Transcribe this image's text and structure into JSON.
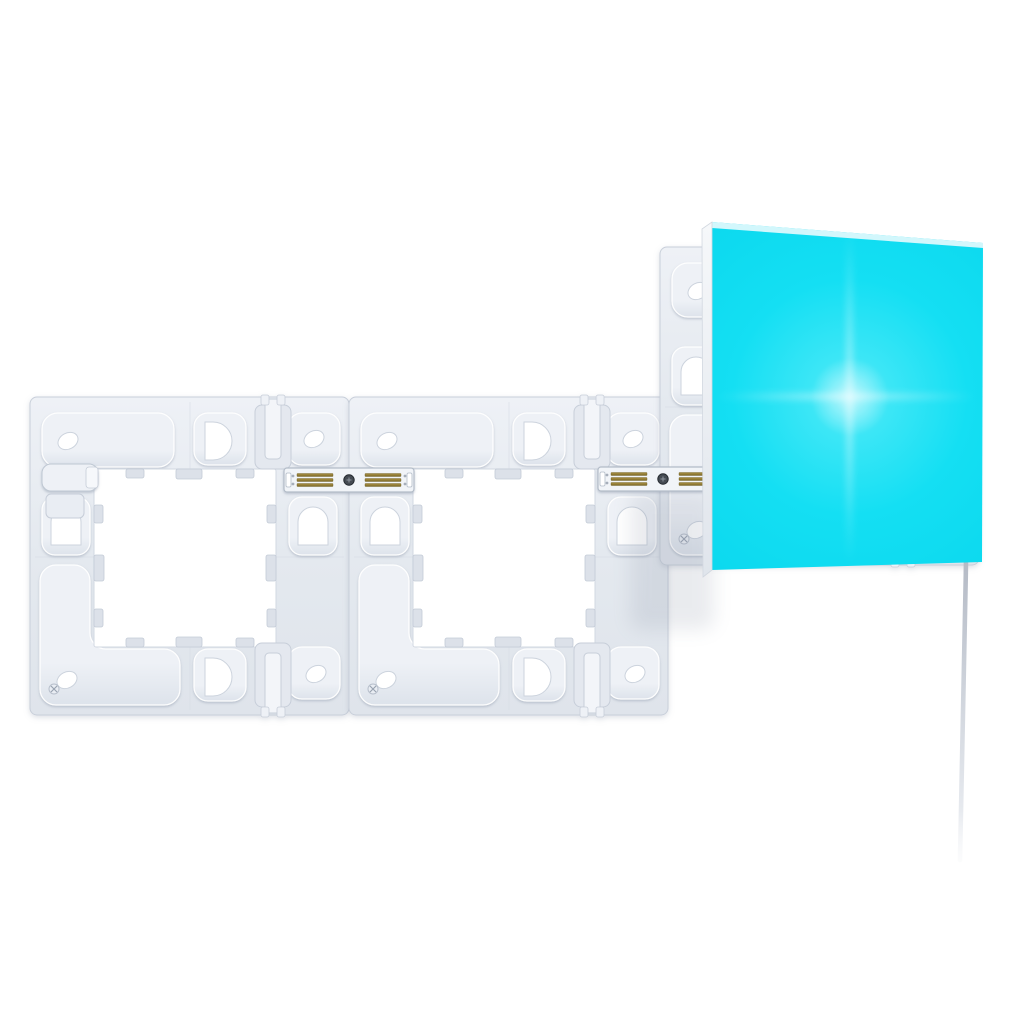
{
  "image": {
    "kind": "product-photo",
    "subject": "modular smart light panel kit: three square mounting plates joined by contact linkers, one illuminated square light panel, and a hanging power cable",
    "background_color": "#ffffff"
  },
  "objects": {
    "mounting_plates": {
      "count": 3,
      "base_color": "#e4e9ef",
      "base_highlight": "#eef1f6",
      "base_low": "#dfe4eb",
      "edge_color": "#c8cfda",
      "pocket_top_color": "#eef1f6",
      "pocket_bottom_color": "#dde3eb",
      "pocket_rim_color": "rgba(255,255,255,0.95)",
      "seam_color": "#d6dbe4",
      "opening_color": "#ffffff",
      "opening_edge_color": "#d2d8e2",
      "tab_color": "#dce1e9",
      "tab_edge_color": "#c3cbd6",
      "hole_color": "#ffffff",
      "hole_edge_color": "#ccd3dd",
      "clip_color": "#e4e8ef",
      "clip_bar_color": "#f3f5f9",
      "clip_edge_color": "#c7ced9",
      "shadow_color": "#8d97aa"
    },
    "linkers": {
      "count": 2,
      "bar_color": "#f1f4f8",
      "edge_color": "#b3bcc8",
      "contact_gold_light": "#ab9245",
      "contact_gold_dark": "#7c6a28",
      "contact_pads_per_linker": 2,
      "contact_stripes_per_pad": 3,
      "screw_color": "#454b53"
    },
    "edge_linker_stub": {
      "count": 1,
      "color": "#eef1f6",
      "edge_color": "#bfc8d3"
    },
    "illuminated_panel": {
      "count": 1,
      "glow_center_color": "#8df1fb",
      "glow_inner_color": "#3ce6f6",
      "glow_mid_color": "#14dff3",
      "glow_base_color": "#0bd8ee",
      "glow_deep_color": "#10d2e7",
      "bevel_color": "#e8fafd",
      "side_edge_light": "#f6f8fa",
      "side_edge_dark": "#e0e5ec",
      "side_edge_outline": "#d2d8e0"
    },
    "power_cable": {
      "count": 1,
      "color_top": "#b4bac5",
      "color_mid": "#cfd4dc",
      "color_low": "#e7eaef",
      "color_fade": "#ffffff"
    }
  }
}
